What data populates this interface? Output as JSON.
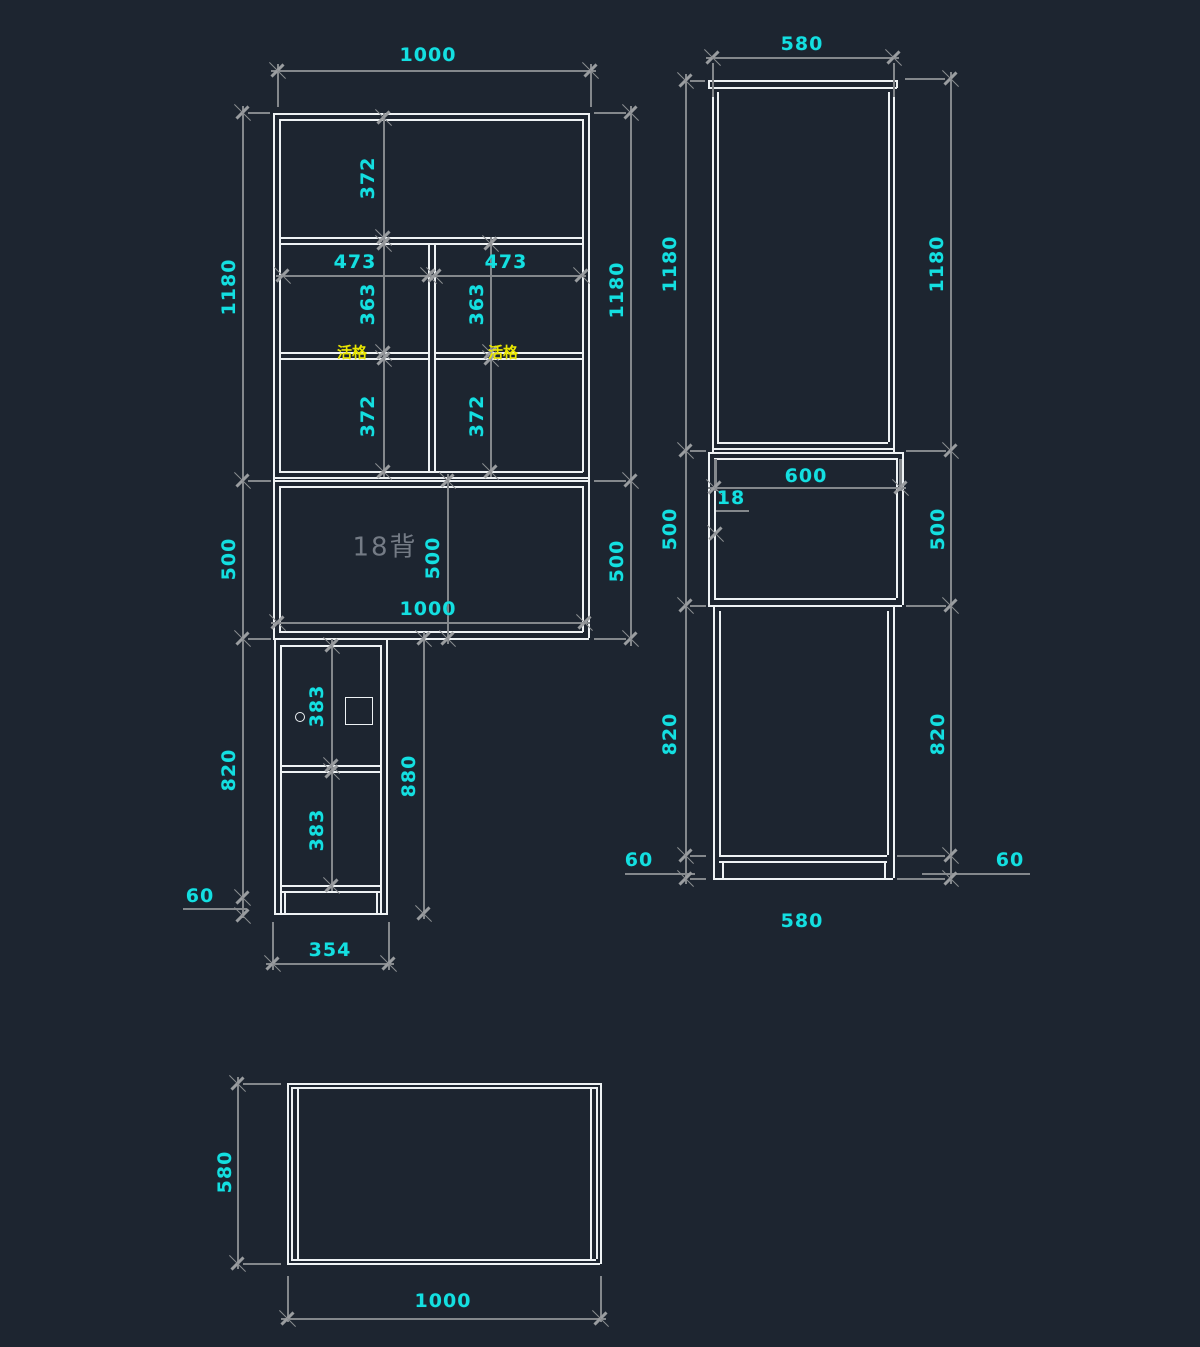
{
  "app": {
    "kind": "cad-drawing",
    "background_color": "#1d2530",
    "object_line_color": "#eef2f4",
    "dimension_line_color": "#84888c",
    "dimension_text_color": "#14dfe0",
    "highlight_text_color": "#e9e600",
    "muted_text_color": "#747b85"
  },
  "views": {
    "front_elevation": {
      "title": "cabinet front elevation",
      "labels": [
        {
          "text": "1000",
          "x": 428,
          "y": 55,
          "rot": "h",
          "style": "dim"
        },
        {
          "text": "1180",
          "x": 229,
          "y": 287,
          "rot": "v",
          "style": "dim"
        },
        {
          "text": "372",
          "x": 368,
          "y": 178,
          "rot": "v",
          "style": "dim"
        },
        {
          "text": "473",
          "x": 355,
          "y": 262,
          "rot": "h",
          "style": "dim"
        },
        {
          "text": "473",
          "x": 506,
          "y": 262,
          "rot": "h",
          "style": "dim"
        },
        {
          "text": "363",
          "x": 368,
          "y": 304,
          "rot": "v",
          "style": "dim"
        },
        {
          "text": "363",
          "x": 477,
          "y": 304,
          "rot": "v",
          "style": "dim"
        },
        {
          "text": "活格",
          "x": 352,
          "y": 352,
          "rot": "h",
          "style": "tag"
        },
        {
          "text": "活格",
          "x": 503,
          "y": 352,
          "rot": "h",
          "style": "tag"
        },
        {
          "text": "372",
          "x": 368,
          "y": 416,
          "rot": "v",
          "style": "dim"
        },
        {
          "text": "372",
          "x": 477,
          "y": 416,
          "rot": "v",
          "style": "dim"
        },
        {
          "text": "1180",
          "x": 617,
          "y": 290,
          "rot": "v",
          "style": "dim"
        },
        {
          "text": "18背",
          "x": 385,
          "y": 545,
          "rot": "h",
          "style": "note"
        },
        {
          "text": "500",
          "x": 433,
          "y": 558,
          "rot": "v",
          "style": "dim"
        },
        {
          "text": "500",
          "x": 229,
          "y": 559,
          "rot": "v",
          "style": "dim"
        },
        {
          "text": "500",
          "x": 617,
          "y": 561,
          "rot": "v",
          "style": "dim"
        },
        {
          "text": "1000",
          "x": 428,
          "y": 609,
          "rot": "h",
          "style": "dim"
        },
        {
          "text": "383",
          "x": 317,
          "y": 706,
          "rot": "v",
          "style": "dim"
        },
        {
          "text": "880",
          "x": 409,
          "y": 776,
          "rot": "v",
          "style": "dim"
        },
        {
          "text": "820",
          "x": 229,
          "y": 770,
          "rot": "v",
          "style": "dim"
        },
        {
          "text": "383",
          "x": 317,
          "y": 830,
          "rot": "v",
          "style": "dim"
        },
        {
          "text": "60",
          "x": 200,
          "y": 896,
          "rot": "h",
          "style": "dim"
        },
        {
          "text": "354",
          "x": 330,
          "y": 950,
          "rot": "h",
          "style": "dim"
        }
      ]
    },
    "side_elevation": {
      "title": "cabinet side elevation",
      "labels": [
        {
          "text": "580",
          "x": 802,
          "y": 44,
          "rot": "h",
          "style": "dim"
        },
        {
          "text": "1180",
          "x": 670,
          "y": 264,
          "rot": "v",
          "style": "dim"
        },
        {
          "text": "1180",
          "x": 937,
          "y": 264,
          "rot": "v",
          "style": "dim"
        },
        {
          "text": "600",
          "x": 806,
          "y": 476,
          "rot": "h",
          "style": "dim"
        },
        {
          "text": "18",
          "x": 731,
          "y": 498,
          "rot": "h",
          "style": "dim"
        },
        {
          "text": "500",
          "x": 670,
          "y": 529,
          "rot": "v",
          "style": "dim"
        },
        {
          "text": "500",
          "x": 938,
          "y": 529,
          "rot": "v",
          "style": "dim"
        },
        {
          "text": "820",
          "x": 670,
          "y": 734,
          "rot": "v",
          "style": "dim"
        },
        {
          "text": "820",
          "x": 938,
          "y": 734,
          "rot": "v",
          "style": "dim"
        },
        {
          "text": "60",
          "x": 639,
          "y": 860,
          "rot": "h",
          "style": "dim"
        },
        {
          "text": "60",
          "x": 1010,
          "y": 860,
          "rot": "h",
          "style": "dim"
        },
        {
          "text": "580",
          "x": 802,
          "y": 921,
          "rot": "h",
          "style": "dim"
        }
      ]
    },
    "plan": {
      "title": "cabinet top plan",
      "labels": [
        {
          "text": "580",
          "x": 225,
          "y": 1172,
          "rot": "v",
          "style": "dim"
        },
        {
          "text": "1000",
          "x": 443,
          "y": 1301,
          "rot": "h",
          "style": "dim"
        }
      ]
    }
  }
}
